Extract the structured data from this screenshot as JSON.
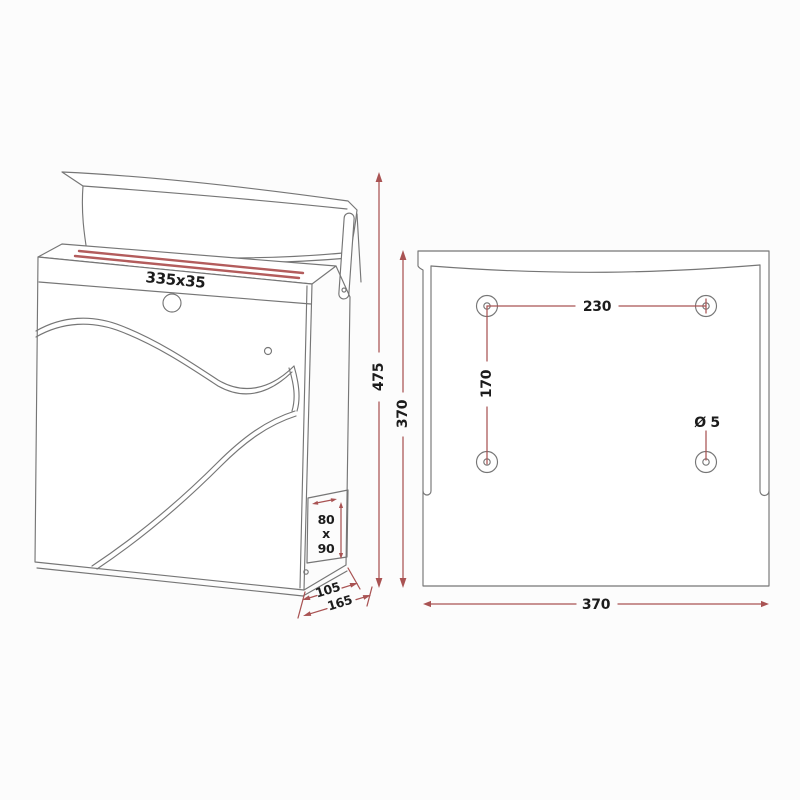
{
  "front_view": {
    "slot_size": "335x35",
    "overall_height": "475",
    "body_height": "370",
    "depth_top": "105",
    "depth_bottom": "165",
    "side_opening": {
      "width": "80",
      "separator": "x",
      "height": "90"
    }
  },
  "back_view": {
    "hole_spacing_horizontal": "230",
    "hole_spacing_vertical": "170",
    "hole_diameter": "Ø 5",
    "plate_width": "370"
  },
  "colors": {
    "line": "#767676",
    "dimension_red": "#a95353",
    "slot_red": "#b35c5c",
    "text": "#1c1c1c",
    "background": "#fcfcfc"
  }
}
